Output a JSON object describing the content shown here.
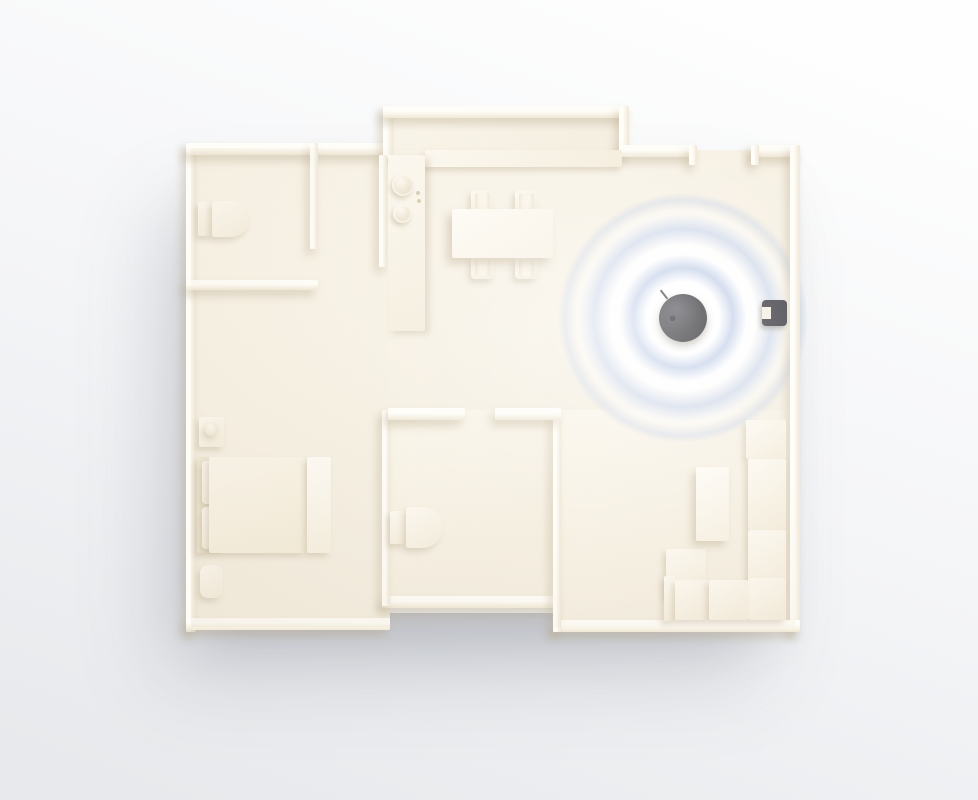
{
  "scene": {
    "kind": "top-down 3d floor plan render",
    "rooms": [
      "bathroom-top-left",
      "closet",
      "kitchen-alcove",
      "dining-area",
      "hallway",
      "bedroom",
      "bathroom-middle",
      "living-room"
    ],
    "furniture": [
      "toilet-top-left",
      "toilet-middle",
      "kitchen-counter",
      "stove-burners",
      "dining-table",
      "dining-chair",
      "dining-chair",
      "dining-chair",
      "dining-chair",
      "bed-with-pillows",
      "nightstand-with-lamp",
      "ottoman",
      "foot-bench",
      "corner-sofa",
      "chaise-cushion",
      "coffee-table"
    ],
    "devices": [
      {
        "name": "smart-hub-puck",
        "appearance": "black round device",
        "location": "living-room floor",
        "signal_rings": 3
      },
      {
        "name": "door-window-sensor",
        "appearance": "small dark block",
        "location": "right wall of living-room"
      }
    ]
  },
  "colors": {
    "bg-top": "#fefefe",
    "bg-mid": "#f4f5f7",
    "bg-bottom": "#e7e9ec",
    "floor": "#f5efe2",
    "floor-light": "#faf5ea",
    "wall": "#f0e8d7",
    "wall-top": "#fffdf8",
    "wall-shadow": "rgba(181,164,136,0.40)",
    "furniture": "#f4eddd",
    "furniture-light": "#fdf9f1",
    "furniture-shadow": "rgba(181,164,136,0.35)",
    "ripple": "#b9c8e4",
    "device-dark": "#232327",
    "device-light": "#47474f",
    "sensor": "#3a3a41",
    "burner": "#e9e0cc"
  }
}
